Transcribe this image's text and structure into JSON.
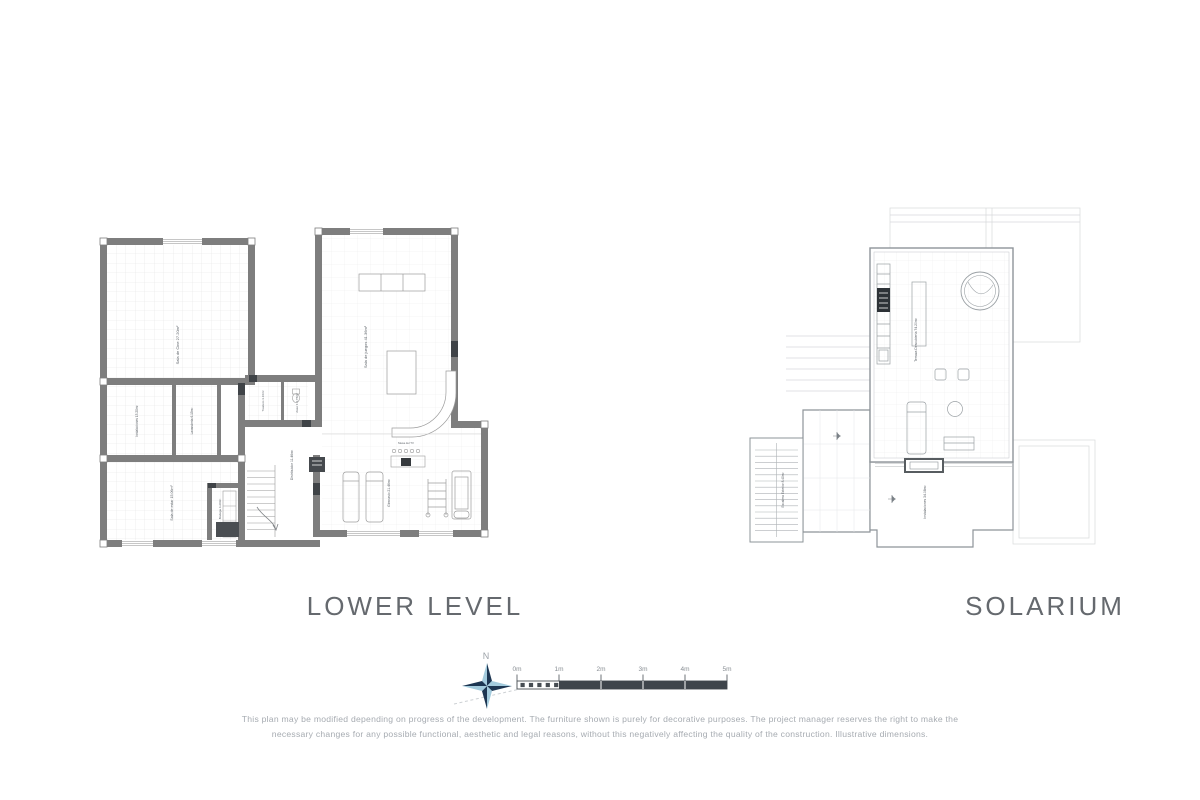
{
  "lower": {
    "title": "LOWER LEVEL",
    "rooms": {
      "cinema": "Sala de Cine 27.20m²",
      "instalaciones": "Instalaciones 13.20m²",
      "lavanderia": "Lavandería 6.15m²",
      "trastero": "Trastero 3.16m²",
      "aseo": "Aseo 1 2.76m²",
      "distribuidor": "Distribuidor 11.46m²",
      "sala_juegos": "Sala de juegos 41.36m²",
      "sala_estar": "Sala de estar 15.06m²",
      "bodega": "Bodega 4.20m²",
      "gimnasio": "Gimnasio 21.46m²",
      "mesa_tv": "Mesa del TV"
    }
  },
  "solarium": {
    "title": "SOLARIUM",
    "rooms": {
      "terraza": "Terraza Descubierta 74.20m²",
      "instalaciones": "Instalaciones 34.08m²",
      "escalera": "Escalera Exterior 8.40m²"
    }
  },
  "compass": {
    "north": "N"
  },
  "scale": {
    "t0": "0m",
    "t1": "1m",
    "t2": "2m",
    "t3": "3m",
    "t4": "4m",
    "t5": "5m"
  },
  "disclaimer": {
    "line1": "This plan may be modified depending on progress of the development. The furniture shown is purely for decorative purposes. The project manager reserves the right to make the",
    "line2": "necessary changes for any possible functional, aesthetic and legal reasons, without this negatively affecting the quality of the construction. Illustrative dimensions."
  }
}
